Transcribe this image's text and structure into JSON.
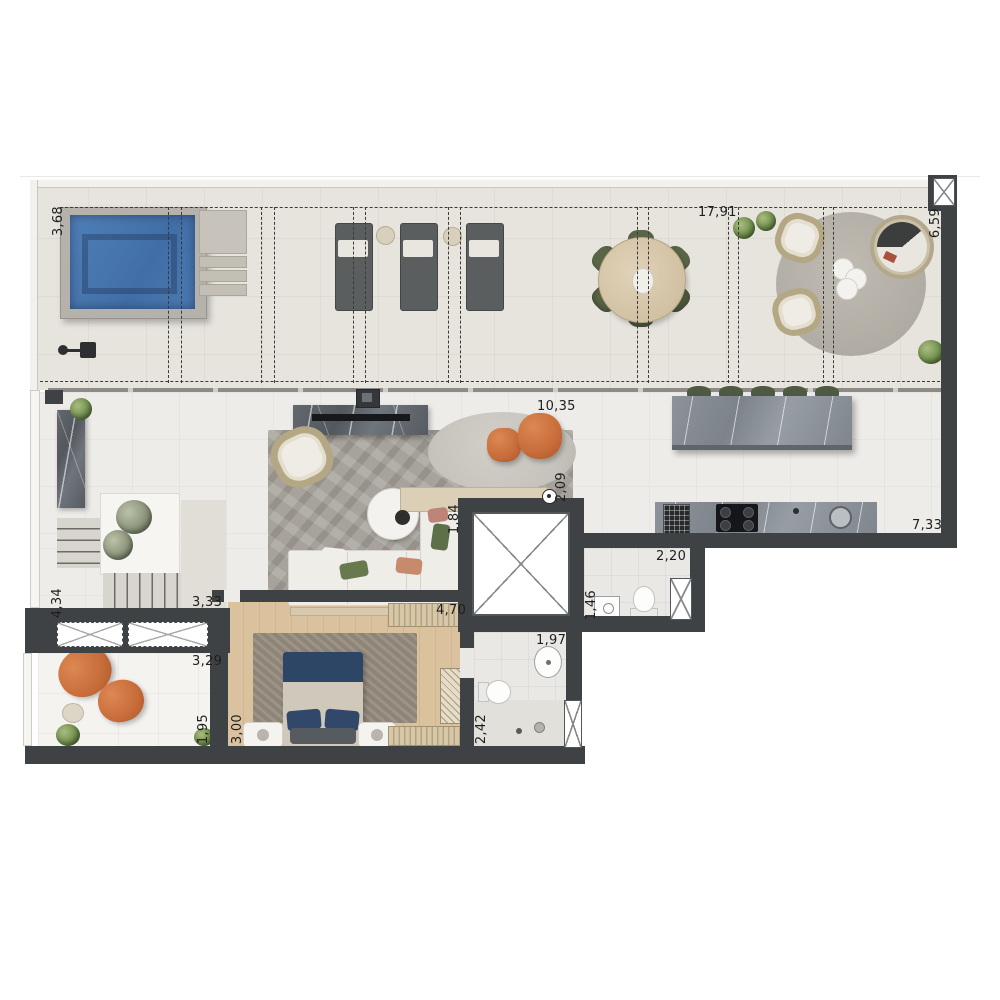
{
  "plan": {
    "dimensions": {
      "pool": "3,68",
      "terrace_top": "17,91",
      "terrace_right": "6,59",
      "gourmet_front": "10,35",
      "gourmet_side": "2,09",
      "elevator": "1,84",
      "kitchen": "7,33",
      "lavabo": "2,20",
      "lavabo_depth": "1,46",
      "stair_hall": "4,34",
      "stair_width": "3,33",
      "balcony": "3,29",
      "balcony_depth": "1,95",
      "bedroom_depth": "3,00",
      "bedroom_width": "4,70",
      "bath_width": "1,97",
      "bath_depth": "2,42"
    },
    "icons": {
      "window": "window-x-icon",
      "elevator": "elevator-shaft-x-icon",
      "closet": "closet-x-icon",
      "shower": "outdoor-shower-icon",
      "level_marker": "level-marker-icon"
    },
    "colors": {
      "wall": "#3f4245",
      "pool_water": "#4a79b1",
      "wood_floor": "#d8c09d",
      "accent_orange": "#c76f41",
      "accent_green": "#5a6547"
    }
  }
}
